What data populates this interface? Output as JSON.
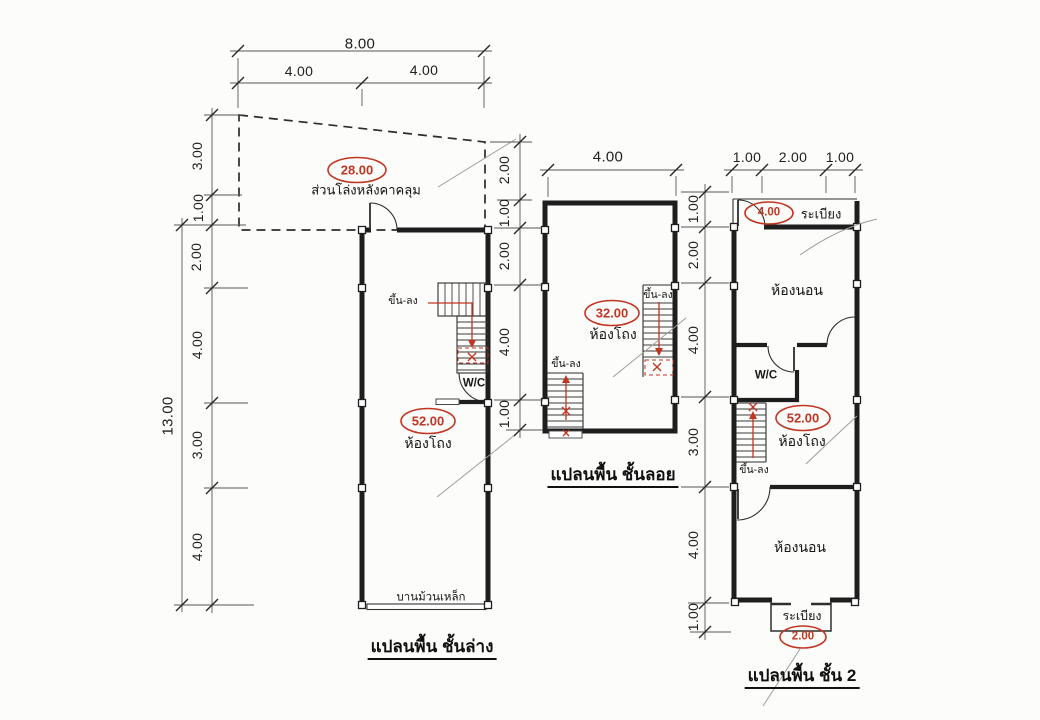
{
  "colors": {
    "accent_red": "#c13622",
    "ink": "#1e1e1e",
    "paper": "#fcfcfa"
  },
  "dims": {
    "top_total": "8.00",
    "top_halves": [
      "4.00",
      "4.00"
    ],
    "left_total": "13.00",
    "left_chain": [
      "3.00",
      "1.00",
      "2.00",
      "4.00",
      "3.00",
      "4.00"
    ],
    "between_chain": [
      "2.00",
      "1.00",
      "2.00",
      "4.00",
      "1.00"
    ],
    "mezzanine_top": "4.00",
    "second_top": [
      "1.00",
      "2.00",
      "1.00"
    ],
    "second_chain": [
      "1.00",
      "2.00",
      "4.00",
      "3.00",
      "4.00",
      "1.00"
    ]
  },
  "plans": {
    "ground": {
      "title": "แปลนพื้น ชั้นล่าง",
      "open_area_label": "ส่วนโล่งหลังคาคลุม",
      "open_area_value": "28.00",
      "stair_label": "ขึ้น-ลง",
      "wc_label": "W/C",
      "hall_label": "ห้องโถง",
      "hall_value": "52.00",
      "shutter_label": "บานม้วนเหล็ก"
    },
    "mezzanine": {
      "title": "แปลนพื้น ชั้นลอย",
      "hall_label": "ห้องโถง",
      "hall_value": "32.00",
      "stair_label_right": "ขึ้น-ลง",
      "stair_label_left": "ขึ้น-ลง"
    },
    "second": {
      "title": "แปลนพื้น ชั้น 2",
      "balcony_top_label": "ระเบียง",
      "balcony_top_value": "4.00",
      "bedroom_front_label": "ห้องนอน",
      "wc_label": "W/C",
      "hall_label": "ห้องโถง",
      "hall_value": "52.00",
      "stair_label": "ขึ้น-ลง",
      "bedroom_back_label": "ห้องนอน",
      "balcony_bottom_label": "ระเบียง",
      "balcony_bottom_value": "2.00"
    }
  }
}
